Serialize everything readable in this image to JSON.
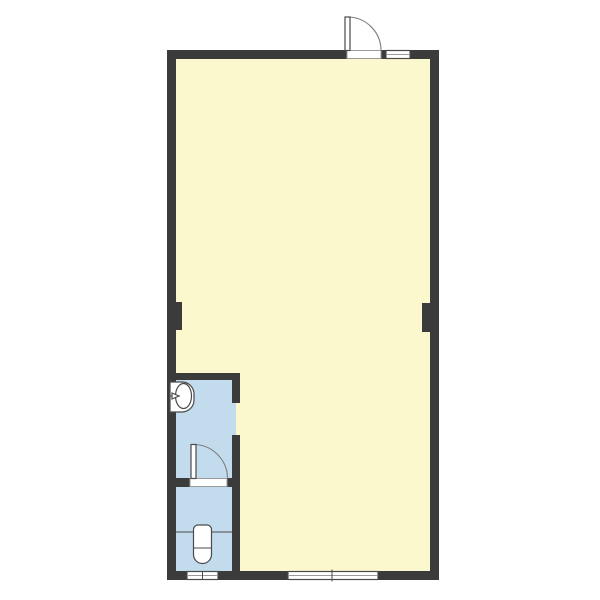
{
  "diagram": {
    "type": "architectural-floor-plan",
    "title": "",
    "colors": {
      "background": "#ffffff",
      "wall": "#3b3b3b",
      "main_room_floor": "#fcf8cd",
      "wet_area_floor": "#c2dcee",
      "fixture_fill": "#ffffff",
      "outline": "#4a4a4a",
      "threshold_stroke": "#9a9a9a",
      "arc_stroke": "#7d7d7d"
    },
    "rooms": [
      {
        "name": "main-room",
        "floor": "main_room_floor"
      },
      {
        "name": "washroom",
        "floor": "wet_area_floor"
      },
      {
        "name": "toilet-room",
        "floor": "wet_area_floor"
      }
    ],
    "symbols": [
      {
        "name": "entry-door-icon",
        "kind": "swing-door",
        "wall": "top"
      },
      {
        "name": "top-window-icon",
        "kind": "window",
        "wall": "top"
      },
      {
        "name": "interior-door-icon",
        "kind": "swing-door",
        "wall": "washroom-toilet-partition"
      },
      {
        "name": "sink-icon",
        "kind": "wash-basin",
        "room": "washroom"
      },
      {
        "name": "toilet-icon",
        "kind": "toilet",
        "room": "toilet-room"
      },
      {
        "name": "toilet-window-icon",
        "kind": "window",
        "wall": "bottom"
      },
      {
        "name": "main-window-icon",
        "kind": "window",
        "wall": "bottom"
      },
      {
        "name": "pillar-left-icon",
        "kind": "structural-column",
        "wall": "left"
      },
      {
        "name": "pillar-right-icon",
        "kind": "structural-column",
        "wall": "right"
      },
      {
        "name": "wall-opening",
        "kind": "doorless-opening",
        "wall": "washroom-right"
      }
    ]
  }
}
